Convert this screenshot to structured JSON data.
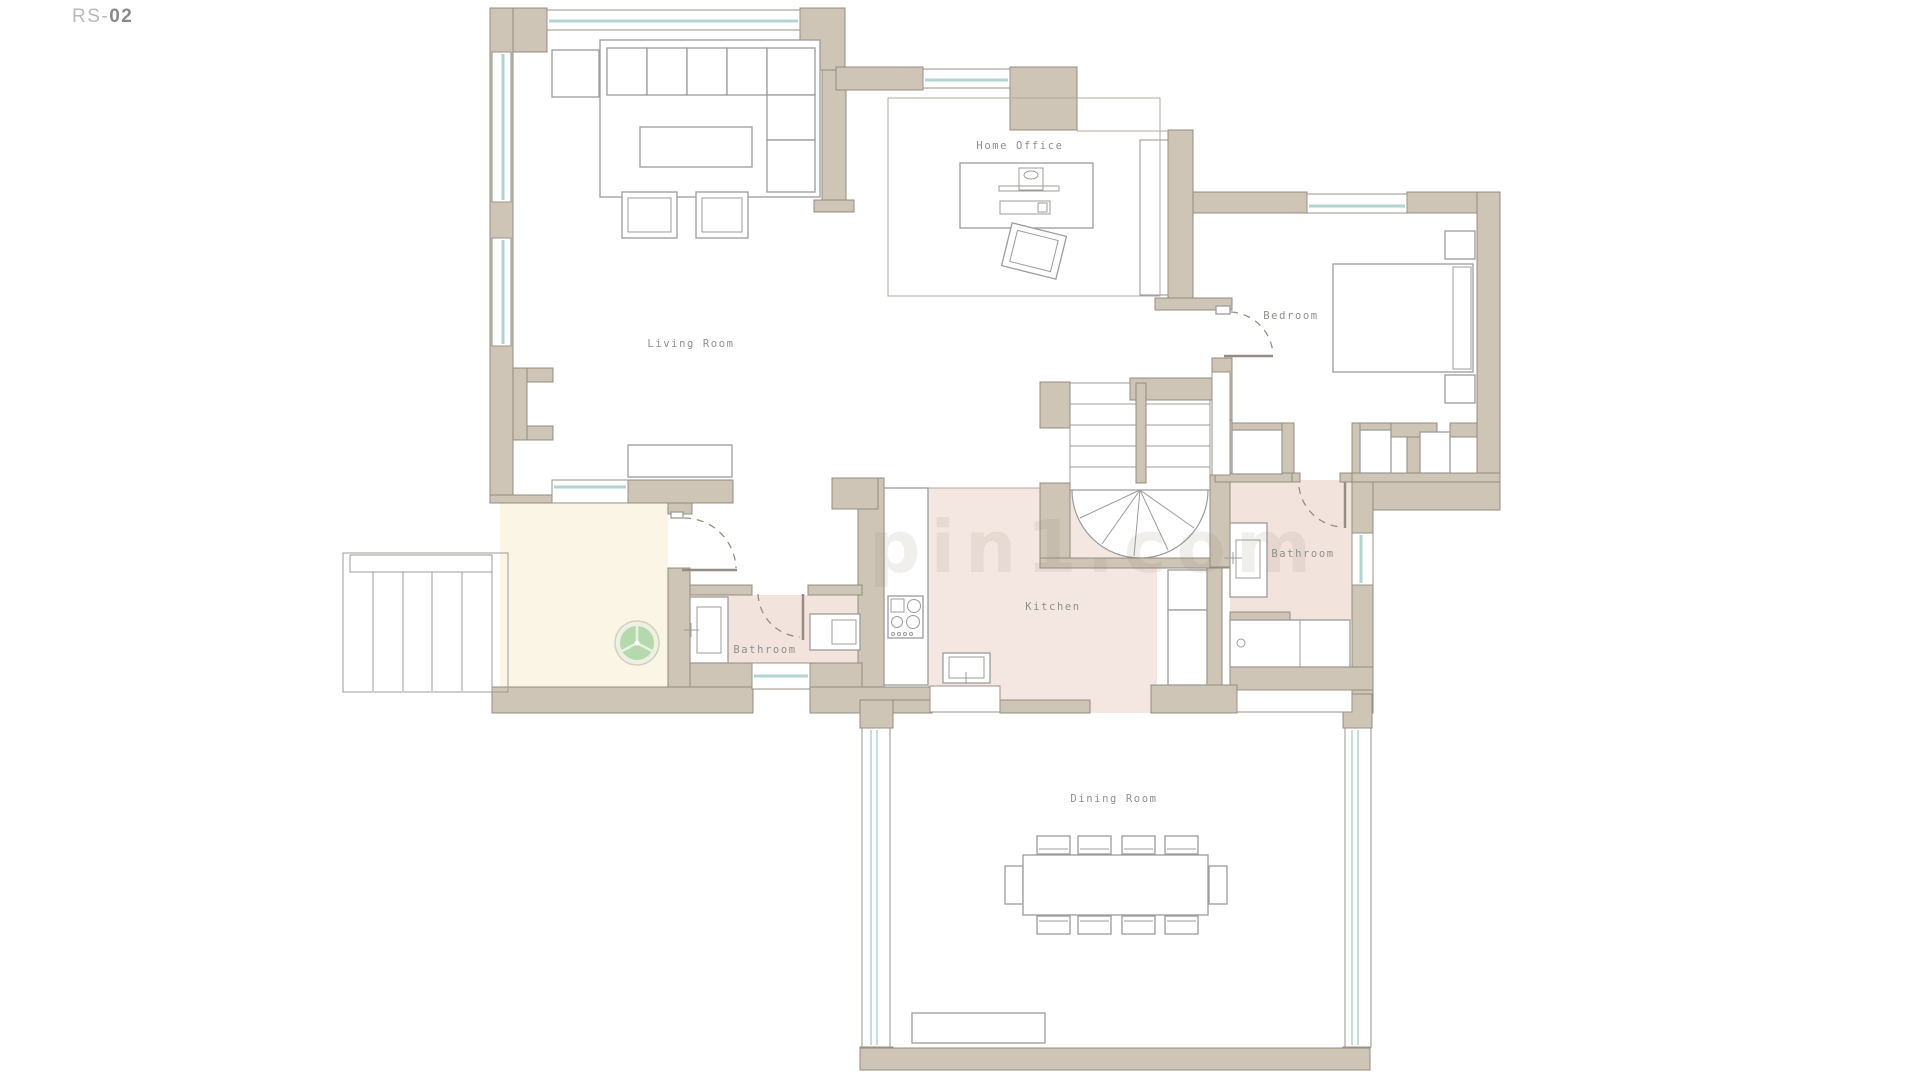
{
  "sheet": {
    "prefix": "RS-",
    "number": "02"
  },
  "watermark": "pin1.com",
  "rooms": {
    "living_room": "Living Room",
    "home_office": "Home Office",
    "bedroom": "Bedroom",
    "bathroom_main": "Bathroom",
    "bathroom_small": "Bathroom",
    "kitchen": "Kitchen",
    "dining_room": "Dining Room"
  },
  "colors": {
    "wall": "#cec5b7",
    "wall_outline": "#948c81",
    "window_glass": "#b2d4d0",
    "kitchen_floor": "#f4e7e1",
    "bathroom_floor": "#f3e3dd",
    "entry_floor": "#faf5e4",
    "plant_green": "#aed6a6",
    "label_text": "#8f8f8d",
    "furniture_line": "#9c9c9a"
  }
}
